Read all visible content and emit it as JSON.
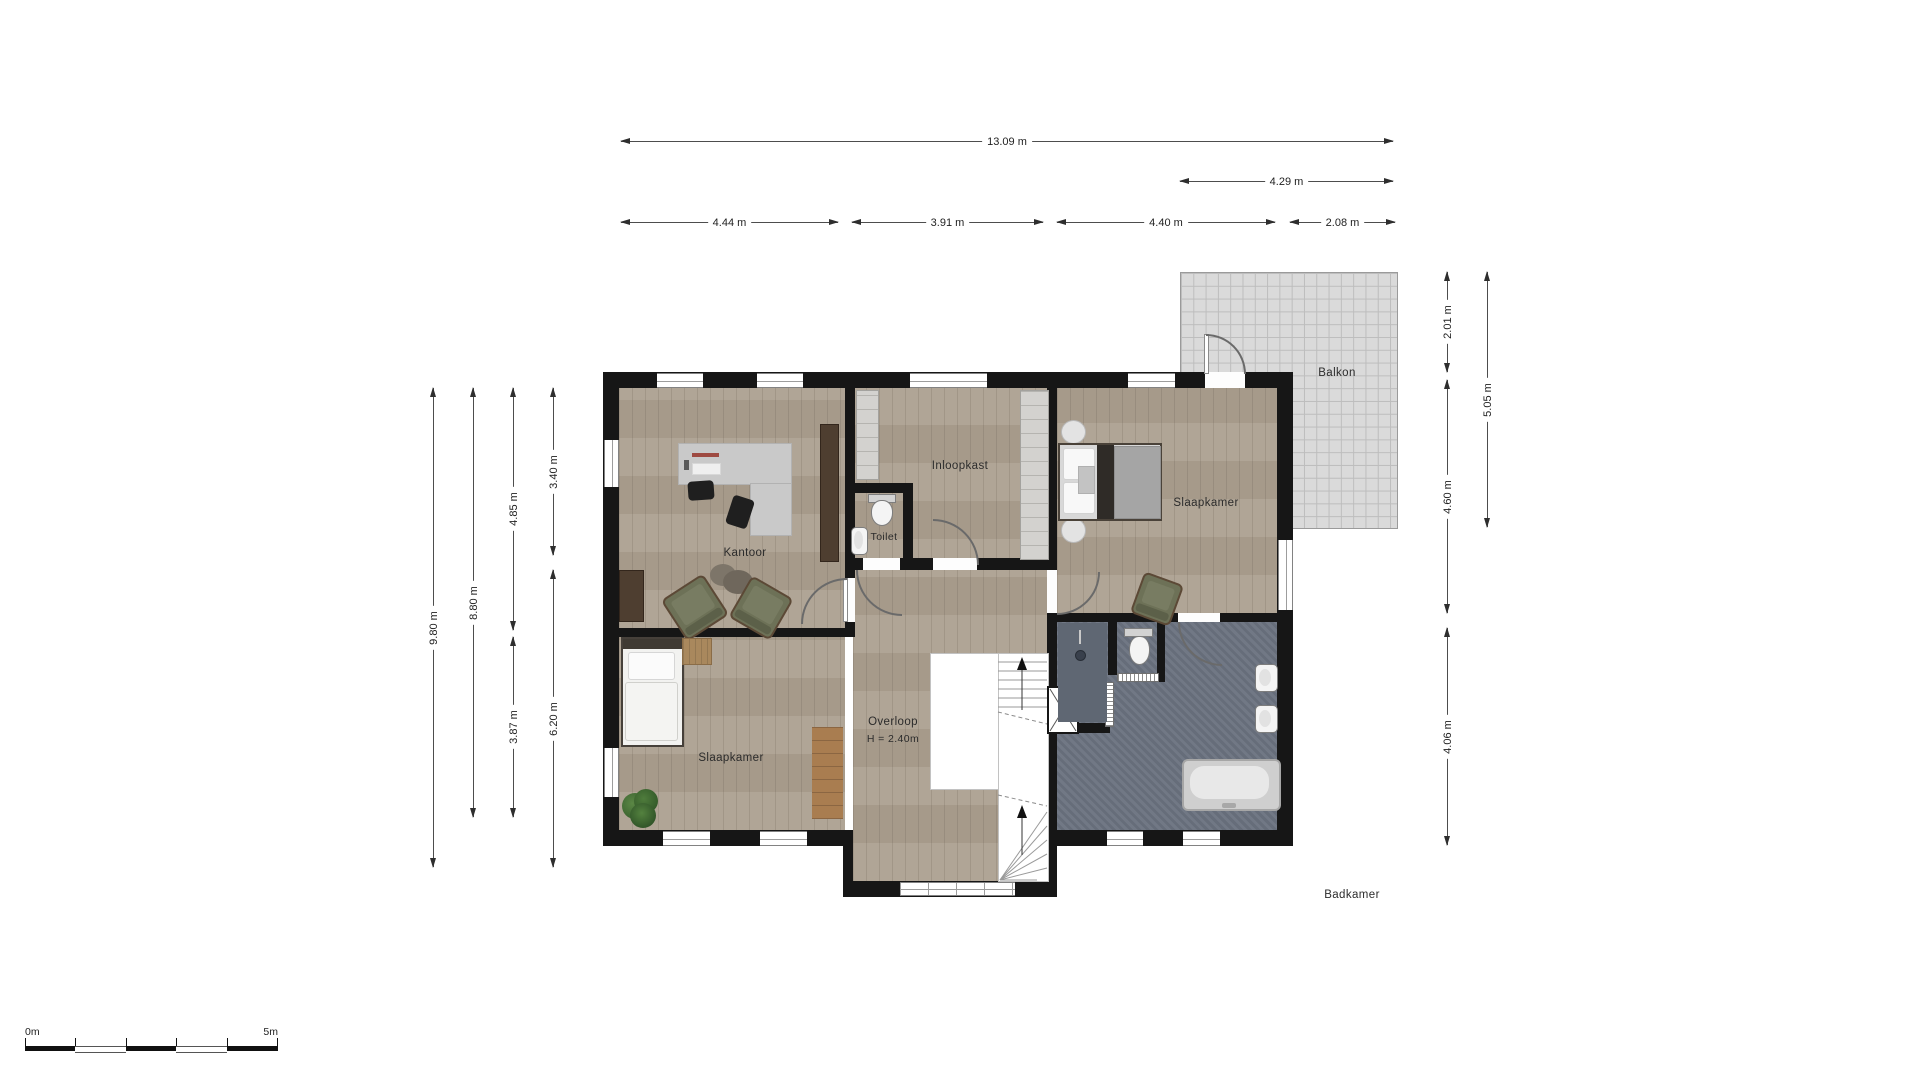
{
  "plan": {
    "rooms": {
      "kantoor": "Kantoor",
      "toilet": "Toilet",
      "inloopkast": "Inloopkast",
      "slaapkamer_right": "Slaapkamer",
      "slaapkamer_left": "Slaapkamer",
      "overloop": "Overloop",
      "overloop_height": "H = 2.40m",
      "badkamer": "Badkamer",
      "balkon": "Balkon"
    },
    "dimensions": {
      "top_total": "13.09 m",
      "balcony_width": "4.29 m",
      "kantoor_width": "4.44 m",
      "middle_width": "3.91 m",
      "right_width": "4.40 m",
      "balcony_overhang": "2.08 m",
      "left_total": "9.80 m",
      "left_interior": "8.80 m",
      "kantoor_depth": "4.85 m",
      "slaapkamer_left_depth": "3.87 m",
      "upper_left_depth": "3.40 m",
      "lower_left_depth": "6.20 m",
      "balcony_top_depth": "2.01 m",
      "balcony_full_depth": "5.05 m",
      "slaapkamer_right_depth": "4.60 m",
      "badkamer_depth": "4.06 m"
    },
    "scale_bar": {
      "start_label": "0m",
      "end_label": "5m"
    }
  }
}
